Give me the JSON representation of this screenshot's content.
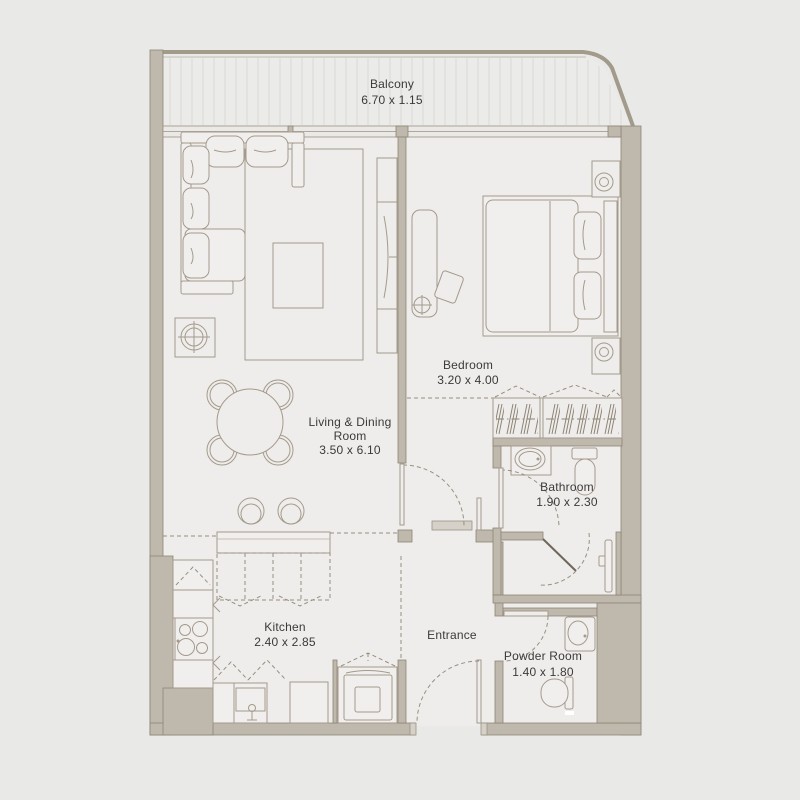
{
  "plan_title": "apartment-floor-plan",
  "rooms": {
    "balcony": {
      "label": "Balcony",
      "dims": "6.70 x 1.15"
    },
    "living": {
      "line1": "Living & Dining",
      "line2": "Room",
      "dims": "3.50 x 6.10"
    },
    "bedroom": {
      "label": "Bedroom",
      "dims": "3.20 x 4.00"
    },
    "bathroom": {
      "label": "Bathroom",
      "dims": "1.90 x 2.30"
    },
    "kitchen": {
      "label": "Kitchen",
      "dims": "2.40 x 2.85"
    },
    "entrance": {
      "label": "Entrance"
    },
    "powder": {
      "label": "Powder Room",
      "dims": "1.40 x 1.80"
    }
  },
  "colors": {
    "background": "#e9e9e8",
    "floor": "#eeedeb",
    "wall": "#bfb8ac",
    "wall_stroke": "#8e8677",
    "furniture_stroke": "#a49a8b",
    "text": "#3b3a38"
  }
}
